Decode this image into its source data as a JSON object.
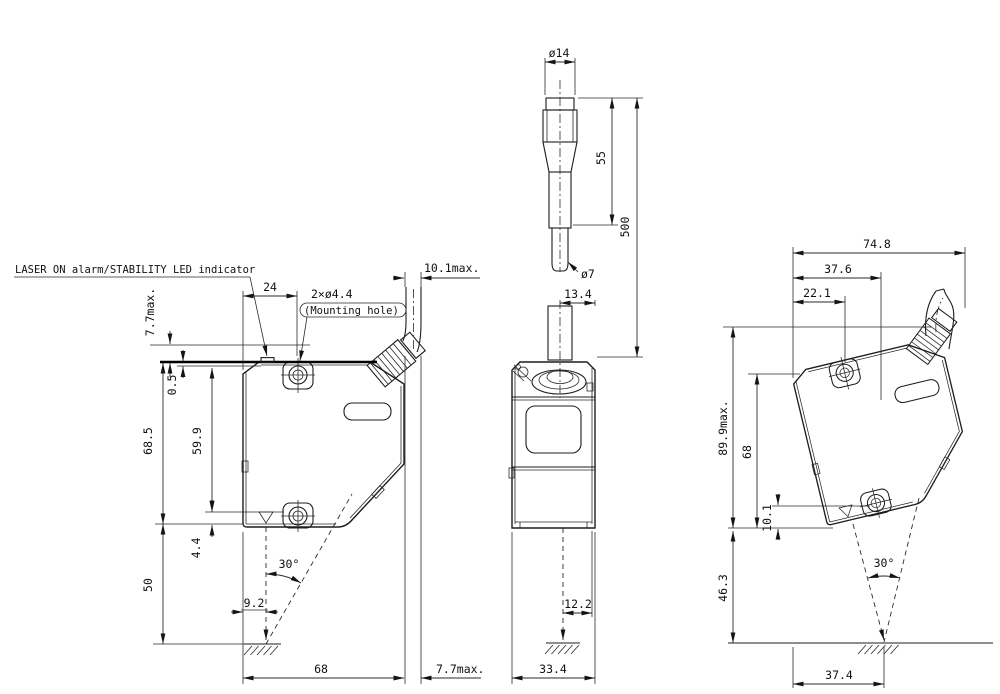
{
  "drawing": {
    "annotations": {
      "led_indicator": "LASER ON alarm/STABILITY LED indicator",
      "mounting_hole_qty": "2×ø4.4",
      "mounting_hole_note": "(Mounting hole)"
    },
    "front_view": {
      "height_max_top": "7.7max.",
      "cable_protrusion_top": "10.1max.",
      "hole_offset": "24",
      "lip": "0.5",
      "body_height": "68.5",
      "hole_to_top": "59.9",
      "hole_to_bottom": "4.4",
      "standoff": "50",
      "beam_offset": "9.2",
      "beam_angle": "30°",
      "body_width": "68",
      "cable_protrusion_bottom": "7.7max."
    },
    "side_view": {
      "connector_dia": "ø14",
      "connector_len": "55",
      "cable_len": "500",
      "cable_dia": "ø7",
      "cable_offset": "13.4",
      "beam_offset": "12.2",
      "body_depth": "33.4"
    },
    "rear_view": {
      "total_width": "74.8",
      "hole2_offset": "37.6",
      "hole1_offset": "22.1",
      "height_max": "89.9max.",
      "body_height": "68",
      "hole_to_bottom": "10.1",
      "standoff": "46.3",
      "beam_angle": "30°",
      "base_width": "37.4"
    }
  }
}
